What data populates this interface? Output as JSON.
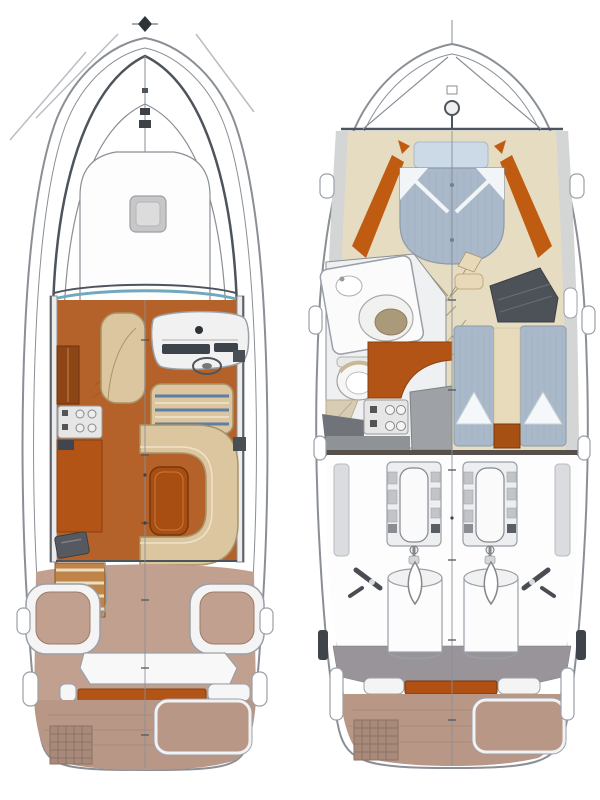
{
  "figure": {
    "kind": "boat-floor-plan-diagram",
    "views": [
      "deck-plan",
      "lower-deck-plan"
    ]
  },
  "palette": {
    "paper": "#ffffff",
    "line": "#8a8f96",
    "line-dark": "#4e545c",
    "line-light": "#babdc3",
    "teal": "#6fa9bc",
    "wood": "#b4622a",
    "wood-dark": "#8e4516",
    "counter": "#b35417",
    "table-orange": "#a84e12",
    "orange-deep": "#a65013",
    "trim-orange": "#bf5c12",
    "tan": "#dcc6a0",
    "tan-line": "#a89468",
    "stripe-blue": "#5b7fa6",
    "step-wood": "#c08448",
    "cream": "#eadfc2",
    "rose": "#c2a090",
    "platform": "#b89787",
    "ladder": "#a8897a",
    "ladder-line": "#8d7263",
    "beige": "#e6dcc2",
    "beige-dark": "#d8cdb4",
    "mattress": "#aab9c9",
    "mattress-line": "#9cadbd",
    "pillow": "#ccd9e6",
    "sheet": "#f2f5f8",
    "hull-strip": "#d2d4d7",
    "gray-mid": "#9aa0a8",
    "gray-deep": "#4d5258",
    "slate": "#99939a",
    "dark": "#3f434a",
    "stove": "#e6e6e6",
    "khaki": "#ab9a7a",
    "white-soft": "#f6f6f4",
    "head-floor": "#eef0f1",
    "engine": "#eceef0",
    "counter-gray": "#9ea2a7"
  },
  "plans": {
    "deck": {
      "areas": [
        "hull",
        "bow-pulpit",
        "anchor-roller",
        "forestay",
        "foredeck-sunpad",
        "deck-hatch",
        "windshield",
        "cockpit-sole",
        "chaise-lounge",
        "galley-cabinet",
        "cooktop",
        "galley-counter",
        "sink-hatch",
        "helm-console",
        "instrument-panel",
        "steering-wheel",
        "helm-seat",
        "u-settee",
        "cockpit-table",
        "companionway-steps",
        "aft-cockpit-floor",
        "port-corner-seat",
        "starboard-corner-seat",
        "transom-sunpad",
        "transom-trim",
        "swim-platform",
        "swim-ladder",
        "platform-hatch",
        "mooring-cleats",
        "centerline"
      ]
    },
    "lower": {
      "areas": [
        "hull",
        "bow-deck",
        "windlass",
        "v-berth",
        "v-berth-pillows",
        "joinery-trim",
        "cabin-sole",
        "folding-table",
        "head-compartment",
        "vanity-counter",
        "washbasin",
        "hand-sink",
        "toilet",
        "shower-floor",
        "galley-sole",
        "cooktop",
        "galley-counter",
        "wardrobe",
        "locker",
        "aft-cabin-port-berth",
        "aft-cabin-starboard-berth",
        "berth-aisle",
        "engine-room-bulkhead",
        "engine-room",
        "port-engine",
        "starboard-engine",
        "propeller-shaft",
        "water-tank",
        "trim-tab",
        "transom",
        "transom-trim",
        "swim-platform",
        "swim-ladder",
        "platform-hatch",
        "mooring-cleats",
        "centerline"
      ]
    }
  }
}
